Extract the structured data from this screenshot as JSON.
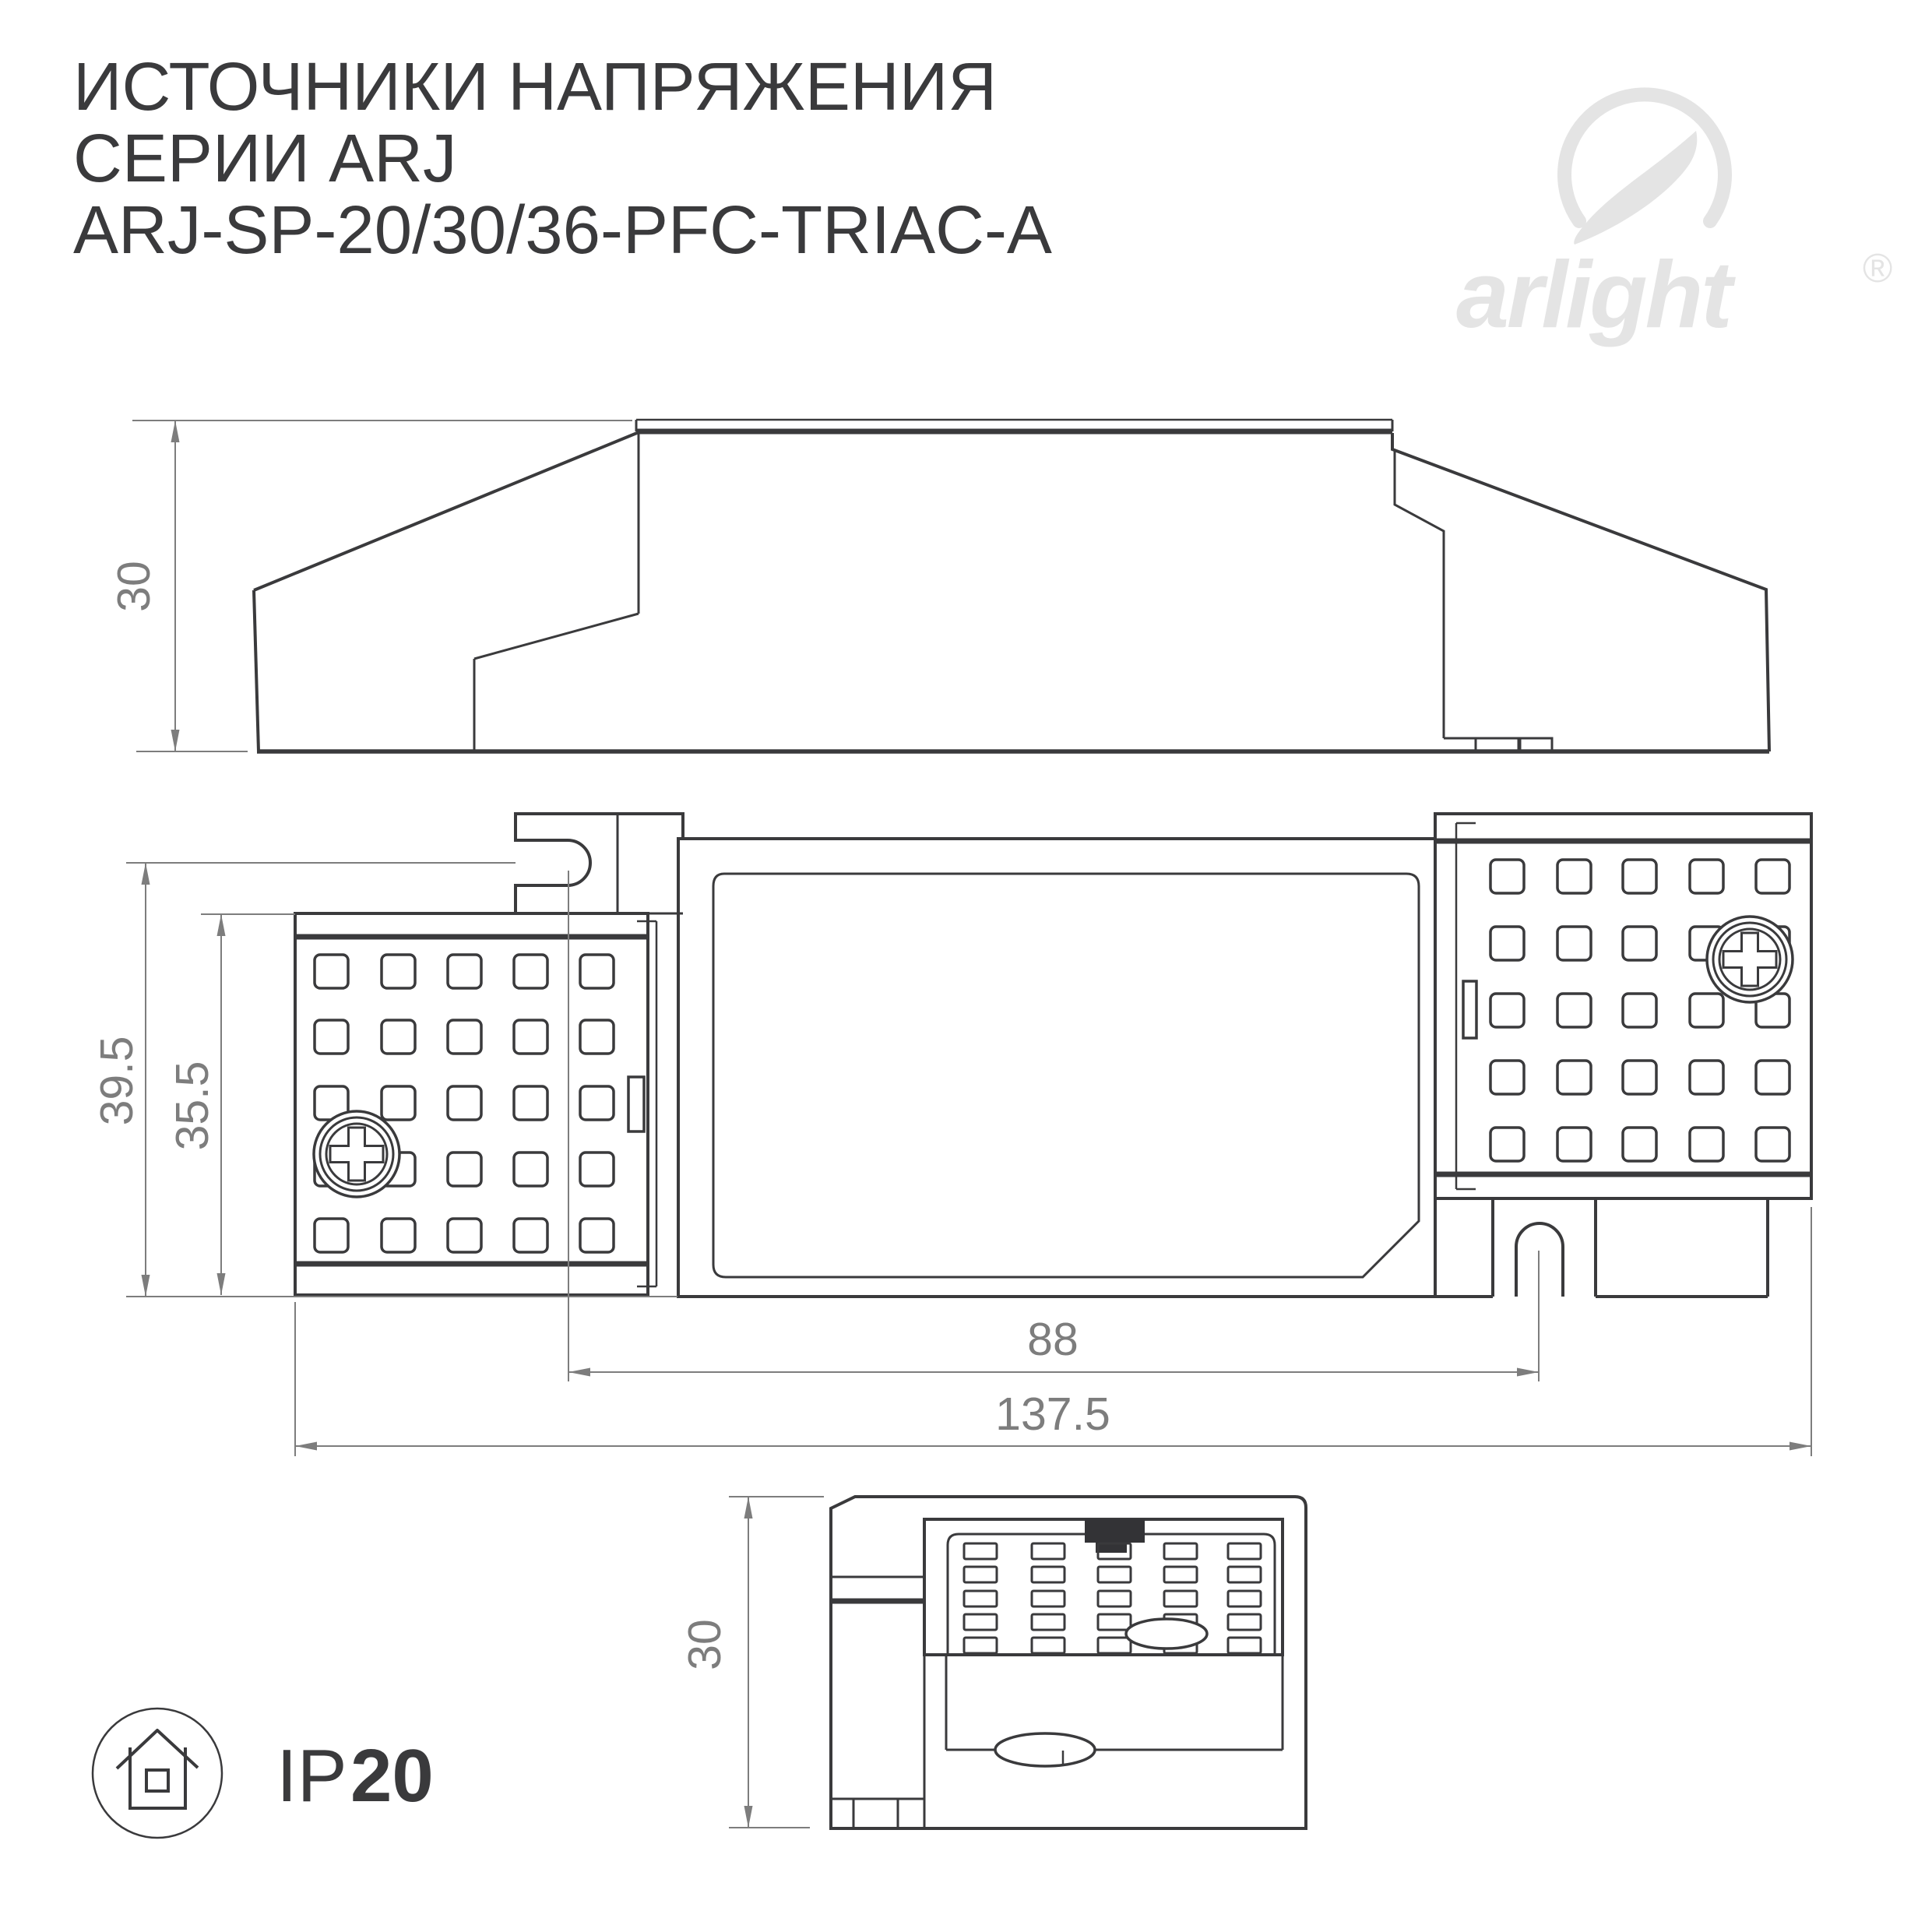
{
  "title": {
    "line1": "ИСТОЧНИКИ НАПРЯЖЕНИЯ",
    "line2": "СЕРИИ ARJ",
    "line3": "ARJ-SP-20/30/36-PFC-TRIAC-A"
  },
  "logo": {
    "brand": "arlight",
    "registered_mark": "®"
  },
  "dimensions": {
    "side_height": "30",
    "plan_outer_width": "39.5",
    "plan_inner_width": "35.5",
    "hole_spacing": "88",
    "overall_length": "137.5",
    "end_height": "30"
  },
  "ip_rating": {
    "prefix": "IP",
    "value": "20"
  },
  "colors": {
    "line": "#3a3a3c",
    "dimension": "#7d7d7d",
    "logo": "#e4e4e4",
    "black_fill": "#333336",
    "background": "#ffffff"
  }
}
